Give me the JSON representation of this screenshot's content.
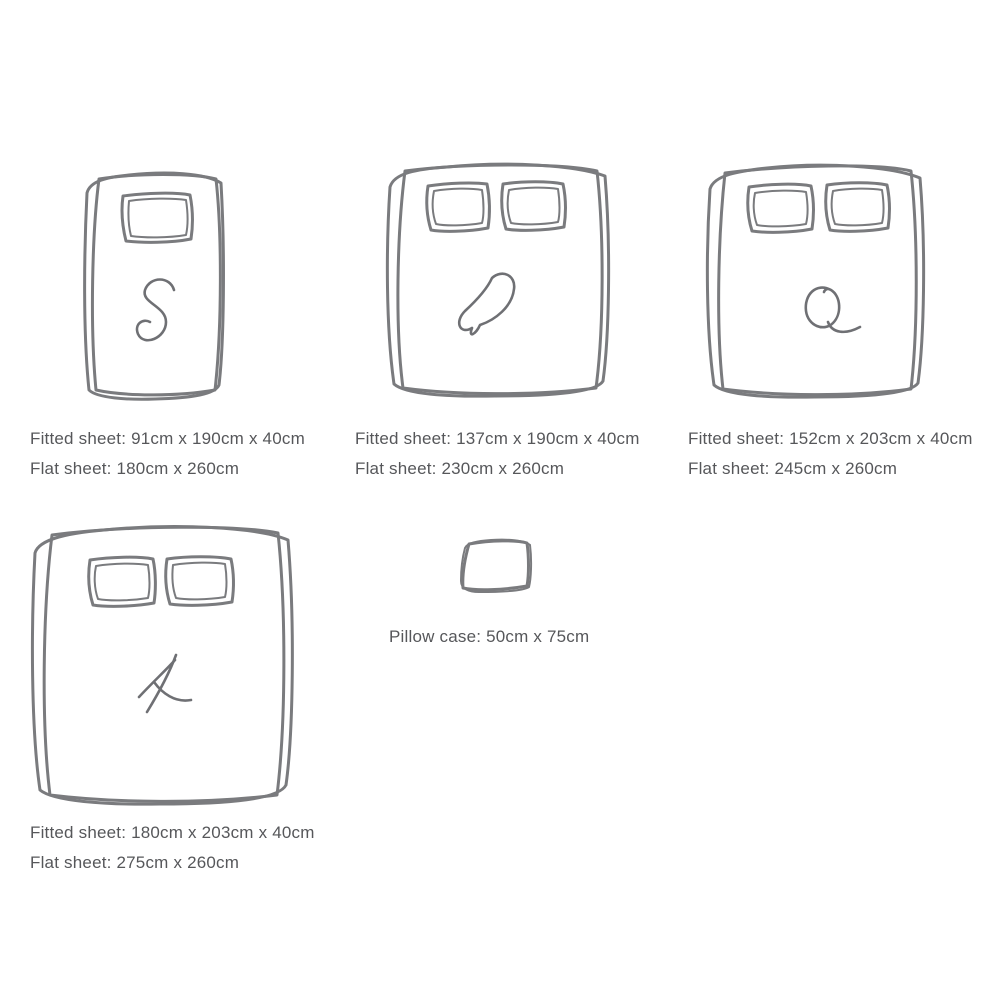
{
  "colors": {
    "background": "#ffffff",
    "line": "#7a7b7e",
    "letter": "#6f7074",
    "text": "#56575a"
  },
  "sizes": [
    {
      "code": "S",
      "fitted": "Fitted sheet: 91cm x 190cm x 40cm",
      "flat": "Flat sheet: 180cm x 260cm"
    },
    {
      "code": "D",
      "fitted": "Fitted sheet: 137cm x 190cm x 40cm",
      "flat": "Flat sheet: 230cm x 260cm"
    },
    {
      "code": "Q",
      "fitted": "Fitted sheet: 152cm x 203cm x 40cm",
      "flat": "Flat sheet: 245cm x 260cm"
    },
    {
      "code": "K",
      "fitted": "Fitted sheet: 180cm x 203cm x 40cm",
      "flat": "Flat sheet: 275cm x 260cm"
    }
  ],
  "pillow_case": {
    "label": "Pillow case: 50cm x 75cm"
  }
}
